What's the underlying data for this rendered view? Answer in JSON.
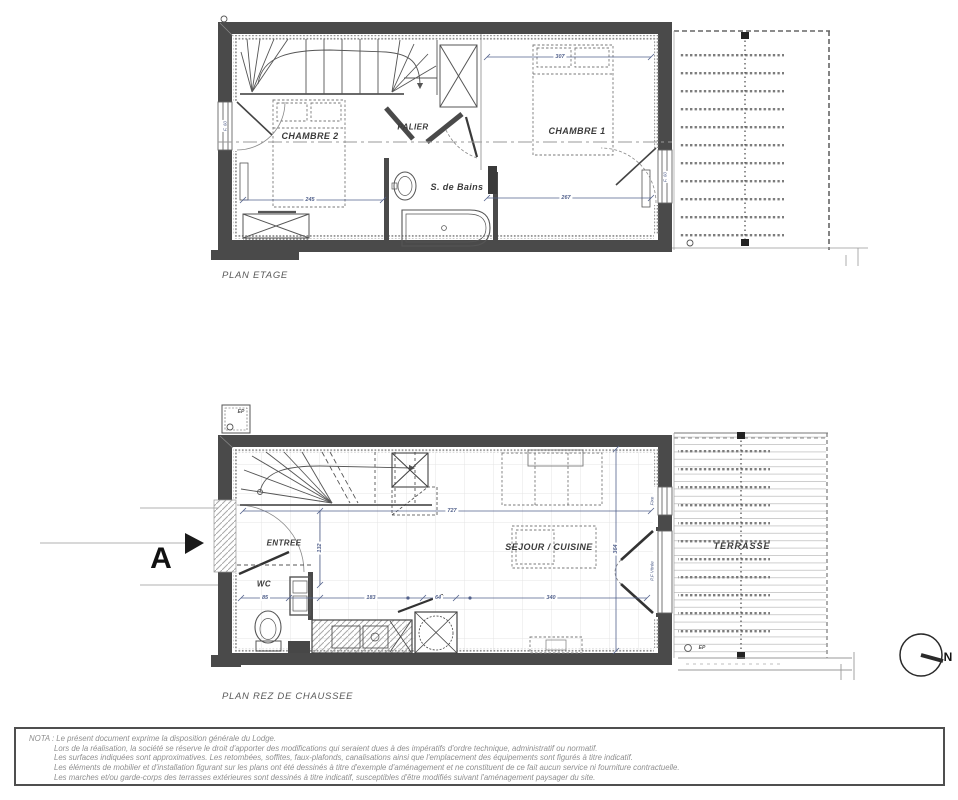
{
  "doc": {
    "etage": {
      "title": "PLAN ETAGE",
      "chambre2": "CHAMBRE 2",
      "palier": "PALIER",
      "sdb": "S. de Bains",
      "chambre1": "CHAMBRE 1",
      "dim_307": "307",
      "dim_245": "245",
      "dim_267": "267",
      "win_left": "F. 60",
      "win_right": "F. 60"
    },
    "rdc": {
      "title": "PLAN REZ DE CHAUSSEE",
      "entree": "ENTREE",
      "wc": "WC",
      "sejour": "SEJOUR / CUISINE",
      "terrasse": "TERRASSE",
      "dim_727": "727",
      "dim_132": "132",
      "dim_85": "85",
      "dim_183": "183",
      "dim_64": "64",
      "dim_340": "340",
      "dim_364": "364",
      "ep": "EP",
      "fixe": "Fixe",
      "pf_vitree": "P.F Vitrée",
      "section": "A"
    },
    "compass_n": "N",
    "nota": {
      "l1": "NOTA : Le présent document exprime la disposition générale du Lodge.",
      "l2": "Lors de la réalisation, la société se réserve le droit d'apporter des modifications qui seraient dues à des impératifs d'ordre technique, administratif ou normatif.",
      "l3": "Les surfaces indiquées sont approximatives. Les retombées, soffites, faux-plafonds, canalisations ainsi que l'emplacement des équipements sont figurés à titre indicatif.",
      "l4": "Les éléments de mobilier et d'installation figurant sur les plans ont été dessinés à titre d'exemple d'aménagement et ne constituent de ce fait aucun service ni fourniture contractuelle.",
      "l5": "Les marches et/ou garde-corps des terrasses extérieures sont dessinés à titre indicatif, susceptibles d'être modifiés suivant l'aménagement paysager du site."
    }
  },
  "colors": {
    "wall": "#4a4a4a",
    "line": "#555555",
    "dim_text": "#52618c",
    "nota_text": "#8f8f8f",
    "deck": "#c9c9c9"
  }
}
